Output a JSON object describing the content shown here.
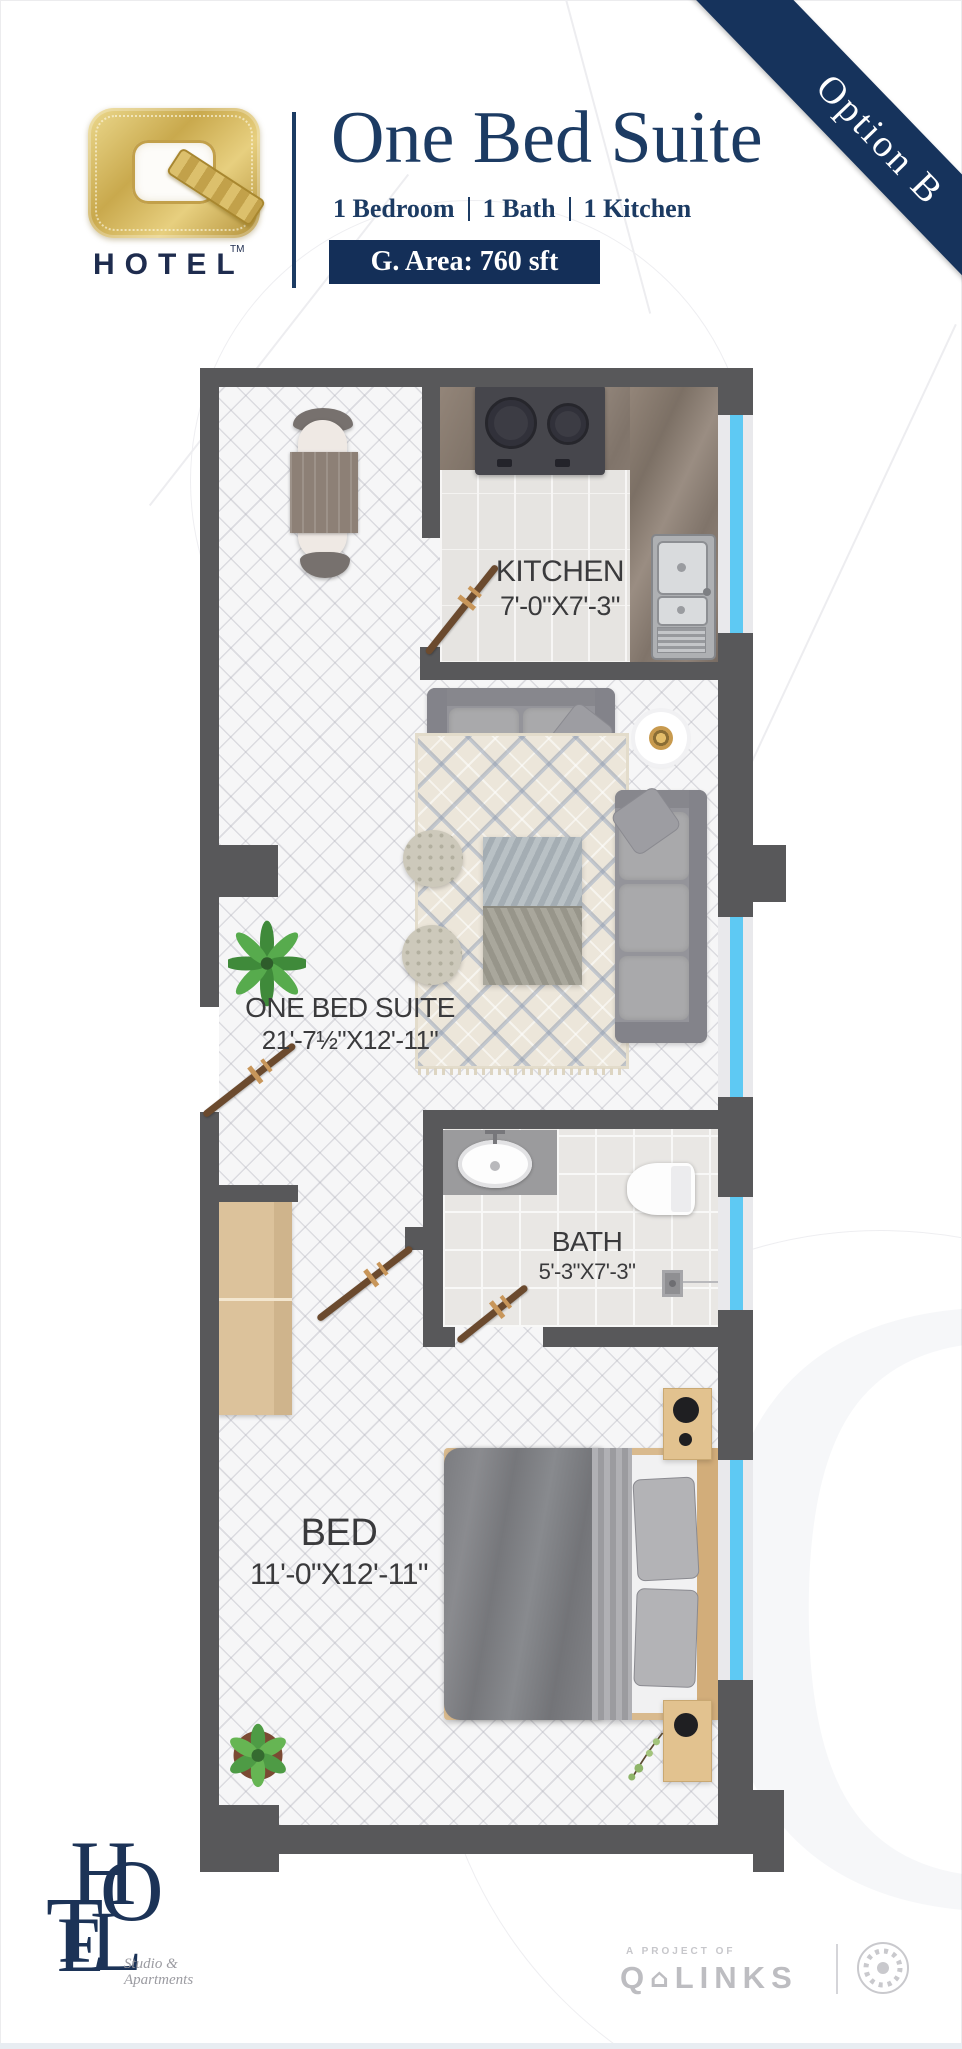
{
  "header": {
    "logo": {
      "letter": "Q",
      "brand": "HOTEL",
      "tm": "TM"
    },
    "title": "One Bed Suite",
    "subtitle": [
      "1 Bedroom",
      "1 Bath",
      "1 Kitchen"
    ],
    "area_badge": "G. Area: 760 sft",
    "ribbon": "Option B"
  },
  "plan": {
    "rooms": [
      {
        "id": "kitchen",
        "name": "KITCHEN",
        "dims": "7'-0\"X7'-3\""
      },
      {
        "id": "suite",
        "name": "ONE BED SUITE",
        "dims": "21'-7½\"X12'-11\""
      },
      {
        "id": "bath",
        "name": "BATH",
        "dims": "5'-3\"X7'-3\""
      },
      {
        "id": "bed",
        "name": "BED",
        "dims": "11'-0\"X12'-11\""
      }
    ],
    "colors": {
      "wall": "#58585a",
      "window_glass": "#5ec9f3",
      "window_frame": "#e9e9ec",
      "door": "#6b4a2e",
      "door_accent": "#c8965a",
      "navy": "#1c3b63",
      "gold": "#c9a94d"
    }
  },
  "footer": {
    "logo_letters": [
      "H",
      "O",
      "T",
      "E",
      "L"
    ],
    "tagline": [
      "Studio &",
      "Apartments"
    ],
    "project_label": "A PROJECT OF",
    "company": {
      "prefix": "Q",
      "house": "⌂",
      "suffix": "LINKS"
    }
  }
}
